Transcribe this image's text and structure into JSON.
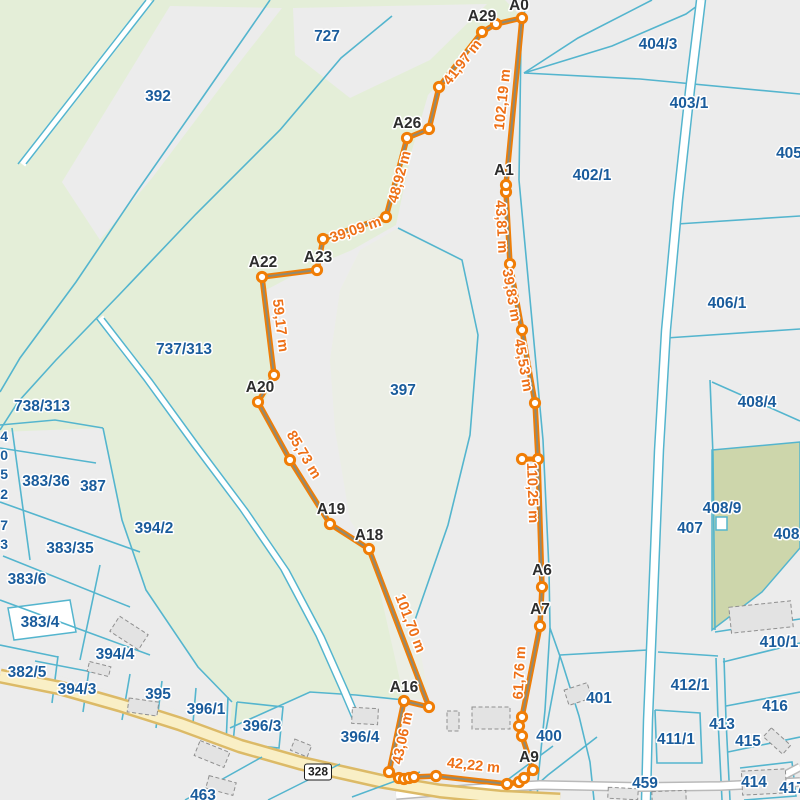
{
  "map": {
    "colors": {
      "background": "#ececec",
      "vegetation": "#e4eed8",
      "vegetation_pale": "#ebeee5",
      "vegetation_dark": "#cdd6ab",
      "parcel_line": "#54b5ce",
      "parcel_text": "#1a5c9c",
      "measure_line": "#f07d05",
      "measure_core": "#8f8a74",
      "measure_text": "#ee7017",
      "vertex_text": "#2d2d2d",
      "road_fill": "#f9efc6",
      "road_casing": "#dcba67",
      "road2_fill": "#ffffff",
      "road2_casing": "#b9b9b9",
      "building_fill": "#e3e3e3",
      "building_stroke": "#8f8f8f"
    },
    "parcel_labels": [
      {
        "text": "727",
        "x": 327,
        "y": 41
      },
      {
        "text": "392",
        "x": 158,
        "y": 101
      },
      {
        "text": "404/3",
        "x": 658,
        "y": 49
      },
      {
        "text": "403/1",
        "x": 689,
        "y": 108
      },
      {
        "text": "405",
        "x": 789,
        "y": 158
      },
      {
        "text": "402/1",
        "x": 592,
        "y": 180
      },
      {
        "text": "406/1",
        "x": 727,
        "y": 308
      },
      {
        "text": "737/313",
        "x": 184,
        "y": 354
      },
      {
        "text": "397",
        "x": 403,
        "y": 395
      },
      {
        "text": "738/313",
        "x": 42,
        "y": 411
      },
      {
        "text": "408/4",
        "x": 757,
        "y": 407
      },
      {
        "text": "383/36",
        "x": 46,
        "y": 486
      },
      {
        "text": "387",
        "x": 93,
        "y": 491
      },
      {
        "text": "408/9",
        "x": 722,
        "y": 513
      },
      {
        "text": "407",
        "x": 690,
        "y": 533
      },
      {
        "text": "408/8",
        "x": 793,
        "y": 539
      },
      {
        "text": "394/2",
        "x": 154,
        "y": 533
      },
      {
        "text": "383/35",
        "x": 70,
        "y": 553
      },
      {
        "text": "383/6",
        "x": 27,
        "y": 584
      },
      {
        "text": "383/4",
        "x": 40,
        "y": 627
      },
      {
        "text": "410/1",
        "x": 779,
        "y": 647
      },
      {
        "text": "394/4",
        "x": 115,
        "y": 659
      },
      {
        "text": "382/5",
        "x": 27,
        "y": 677
      },
      {
        "text": "394/3",
        "x": 77,
        "y": 694
      },
      {
        "text": "395",
        "x": 158,
        "y": 699
      },
      {
        "text": "401",
        "x": 599,
        "y": 703
      },
      {
        "text": "396/1",
        "x": 206,
        "y": 714
      },
      {
        "text": "412/1",
        "x": 690,
        "y": 690
      },
      {
        "text": "396/4",
        "x": 360,
        "y": 742
      },
      {
        "text": "400",
        "x": 549,
        "y": 741
      },
      {
        "text": "413",
        "x": 722,
        "y": 729
      },
      {
        "text": "416",
        "x": 775,
        "y": 711
      },
      {
        "text": "411/1",
        "x": 676,
        "y": 744
      },
      {
        "text": "415",
        "x": 748,
        "y": 746
      },
      {
        "text": "396/3",
        "x": 262,
        "y": 731
      },
      {
        "text": "459",
        "x": 645,
        "y": 788
      },
      {
        "text": "414",
        "x": 754,
        "y": 787
      },
      {
        "text": "417",
        "x": 792,
        "y": 793
      },
      {
        "text": "463",
        "x": 203,
        "y": 800
      }
    ],
    "edge_fragments": [
      {
        "text": "4",
        "x": 8,
        "y": 441
      },
      {
        "text": "0",
        "x": 8,
        "y": 460
      },
      {
        "text": "5",
        "x": 8,
        "y": 479
      },
      {
        "text": "2",
        "x": 8,
        "y": 499
      },
      {
        "text": "7",
        "x": 8,
        "y": 530
      },
      {
        "text": "3",
        "x": 8,
        "y": 549
      }
    ],
    "road_badge": {
      "text": "328",
      "x": 318,
      "y": 772
    },
    "measurement": {
      "path": [
        [
          522,
          18
        ],
        [
          496,
          24
        ],
        [
          482,
          32
        ],
        [
          439,
          87
        ],
        [
          429,
          129
        ],
        [
          407,
          138
        ],
        [
          386,
          217
        ],
        [
          323,
          239
        ],
        [
          317,
          270
        ],
        [
          262,
          277
        ],
        [
          274,
          375
        ],
        [
          258,
          402
        ],
        [
          290,
          460
        ],
        [
          330,
          524
        ],
        [
          369,
          549
        ],
        [
          429,
          707
        ],
        [
          404,
          701
        ],
        [
          389,
          772
        ],
        [
          399,
          778
        ],
        [
          404,
          779
        ],
        [
          409,
          778
        ],
        [
          414,
          777
        ],
        [
          436,
          776
        ],
        [
          507,
          784
        ],
        [
          519,
          782
        ],
        [
          524,
          778
        ],
        [
          533,
          770
        ],
        [
          522,
          736
        ],
        [
          519,
          726
        ],
        [
          522,
          717
        ],
        [
          540,
          626
        ],
        [
          542,
          587
        ],
        [
          538,
          459
        ],
        [
          535,
          403
        ],
        [
          522,
          330
        ],
        [
          510,
          264
        ],
        [
          506,
          192
        ],
        [
          506,
          185
        ]
      ],
      "spur": [
        [
          538,
          459
        ],
        [
          522,
          459
        ]
      ],
      "vertex_labels": [
        {
          "text": "A0",
          "x": 519,
          "y": 10
        },
        {
          "text": "A29",
          "x": 482,
          "y": 21
        },
        {
          "text": "A1",
          "x": 504,
          "y": 175
        },
        {
          "text": "A26",
          "x": 407,
          "y": 128
        },
        {
          "text": "A23",
          "x": 318,
          "y": 262
        },
        {
          "text": "A22",
          "x": 263,
          "y": 267
        },
        {
          "text": "A20",
          "x": 260,
          "y": 392
        },
        {
          "text": "A19",
          "x": 331,
          "y": 514
        },
        {
          "text": "A18",
          "x": 369,
          "y": 540
        },
        {
          "text": "A16",
          "x": 404,
          "y": 692
        },
        {
          "text": "A6",
          "x": 542,
          "y": 575
        },
        {
          "text": "A7",
          "x": 540,
          "y": 614
        },
        {
          "text": "A9",
          "x": 529,
          "y": 762
        }
      ],
      "distance_labels": [
        {
          "text": "102,19 m",
          "x": 507,
          "y": 100,
          "rot": -84
        },
        {
          "text": "41,97 m",
          "x": 466,
          "y": 65,
          "rot": -52
        },
        {
          "text": "48,92 m",
          "x": 404,
          "y": 178,
          "rot": -75
        },
        {
          "text": "39,09 m",
          "x": 357,
          "y": 234,
          "rot": -19
        },
        {
          "text": "59,17 m",
          "x": 276,
          "y": 326,
          "rot": 83
        },
        {
          "text": "85,73 m",
          "x": 300,
          "y": 457,
          "rot": 59
        },
        {
          "text": "101,70 m",
          "x": 406,
          "y": 625,
          "rot": 69
        },
        {
          "text": "43,06 m",
          "x": 407,
          "y": 739,
          "rot": -78
        },
        {
          "text": "42,22 m",
          "x": 473,
          "y": 770,
          "rot": 6
        },
        {
          "text": "61,76 m",
          "x": 524,
          "y": 673,
          "rot": -87
        },
        {
          "text": "110,25 m",
          "x": 528,
          "y": 493,
          "rot": 88
        },
        {
          "text": "45,53 m",
          "x": 519,
          "y": 366,
          "rot": 80
        },
        {
          "text": "39,83 m",
          "x": 507,
          "y": 296,
          "rot": 80
        },
        {
          "text": "43,81 m",
          "x": 497,
          "y": 227,
          "rot": 87
        }
      ]
    }
  }
}
